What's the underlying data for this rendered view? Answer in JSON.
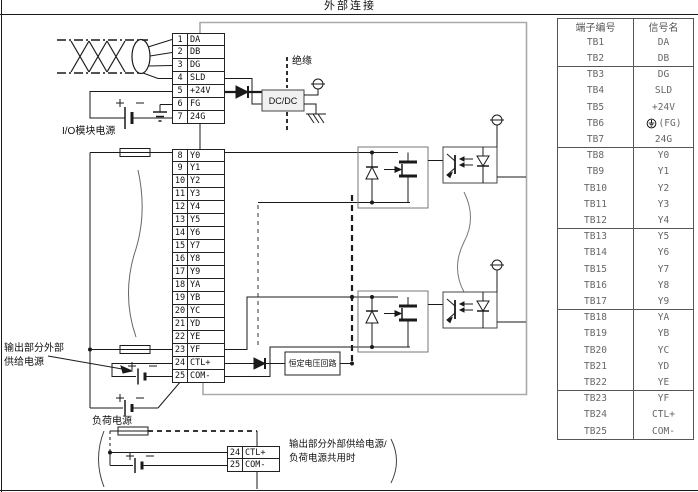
{
  "page": {
    "title": "外部连接"
  },
  "diagram": {
    "labels": {
      "io_power": "I/O模块电源",
      "isolation": "绝缘",
      "dcdc": "DC/DC",
      "cv_circuit": "恒定电压回路",
      "ext_supply_line1": "输出部分外部",
      "ext_supply_line2": "供给电源",
      "load_power": "负荷电源",
      "shared_note_line1": "输出部分外部供给电源/",
      "shared_note_line2": "负荷电源共用时"
    },
    "terminal_block": {
      "groups": [
        [
          {
            "n": "1",
            "label": "DA"
          },
          {
            "n": "2",
            "label": "DB"
          },
          {
            "n": "3",
            "label": "DG"
          },
          {
            "n": "4",
            "label": "SLD"
          },
          {
            "n": "5",
            "label": "+24V"
          },
          {
            "n": "6",
            "label": "FG"
          },
          {
            "n": "7",
            "label": "24G"
          }
        ],
        [
          {
            "n": "8",
            "label": "Y0"
          },
          {
            "n": "9",
            "label": "Y1"
          },
          {
            "n": "10",
            "label": "Y2"
          },
          {
            "n": "11",
            "label": "Y3"
          },
          {
            "n": "12",
            "label": "Y4"
          },
          {
            "n": "13",
            "label": "Y5"
          },
          {
            "n": "14",
            "label": "Y6"
          },
          {
            "n": "15",
            "label": "Y7"
          },
          {
            "n": "16",
            "label": "Y8"
          },
          {
            "n": "17",
            "label": "Y9"
          },
          {
            "n": "18",
            "label": "YA"
          },
          {
            "n": "19",
            "label": "YB"
          },
          {
            "n": "20",
            "label": "YC"
          },
          {
            "n": "21",
            "label": "YD"
          },
          {
            "n": "22",
            "label": "YE"
          },
          {
            "n": "23",
            "label": "YF"
          },
          {
            "n": "24",
            "label": "CTL+"
          },
          {
            "n": "25",
            "label": "COM-"
          }
        ]
      ]
    },
    "mini_terminal_block": [
      {
        "n": "24",
        "label": "CTL+"
      },
      {
        "n": "25",
        "label": "COM-"
      }
    ]
  },
  "table": {
    "headers": [
      "端子编号",
      "信号名"
    ],
    "rows": [
      {
        "tb": "TB1",
        "signal": "DA"
      },
      {
        "tb": "TB2",
        "signal": "DB"
      },
      {
        "tb": "TB3",
        "signal": "DG"
      },
      {
        "tb": "TB4",
        "signal": "SLD"
      },
      {
        "tb": "TB5",
        "signal": "+24V"
      },
      {
        "tb": "TB6",
        "signal": "(FG)",
        "icon": "protective-earth-icon"
      },
      {
        "tb": "TB7",
        "signal": "24G"
      },
      {
        "tb": "TB8",
        "signal": "Y0"
      },
      {
        "tb": "TB9",
        "signal": "Y1"
      },
      {
        "tb": "TB10",
        "signal": "Y2"
      },
      {
        "tb": "TB11",
        "signal": "Y3"
      },
      {
        "tb": "TB12",
        "signal": "Y4"
      },
      {
        "tb": "TB13",
        "signal": "Y5"
      },
      {
        "tb": "TB14",
        "signal": "Y6"
      },
      {
        "tb": "TB15",
        "signal": "Y7"
      },
      {
        "tb": "TB16",
        "signal": "Y8"
      },
      {
        "tb": "TB17",
        "signal": "Y9"
      },
      {
        "tb": "TB18",
        "signal": "YA"
      },
      {
        "tb": "TB19",
        "signal": "YB"
      },
      {
        "tb": "TB20",
        "signal": "YC"
      },
      {
        "tb": "TB21",
        "signal": "YD"
      },
      {
        "tb": "TB22",
        "signal": "YE"
      },
      {
        "tb": "TB23",
        "signal": "YF"
      },
      {
        "tb": "TB24",
        "signal": "CTL+"
      },
      {
        "tb": "TB25",
        "signal": "COM-"
      }
    ]
  }
}
